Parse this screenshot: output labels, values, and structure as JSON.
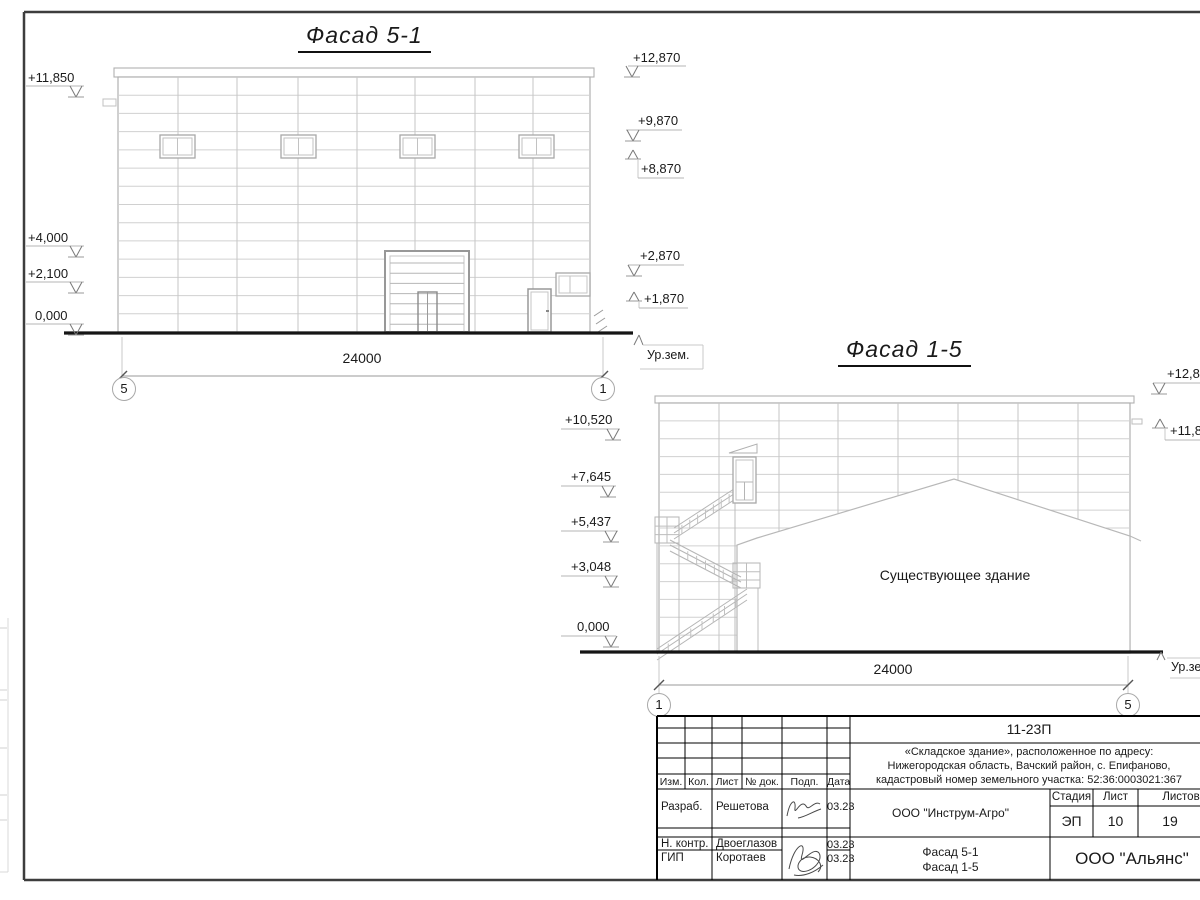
{
  "facade51": {
    "title": "Фасад 5-1",
    "marks_left": [
      "+11,850",
      "+4,000",
      "+2,100",
      "0,000"
    ],
    "marks_right": [
      "+12,870",
      "+9,870",
      "+8,870",
      "+2,870",
      "+1,870"
    ],
    "dim": "24000",
    "axis_left": "5",
    "axis_right": "1",
    "ground_label": "Ур.зем."
  },
  "facade15": {
    "title": "Фасад 1-5",
    "marks_left": [
      "+10,520",
      "+7,645",
      "+5,437",
      "+3,048",
      "0,000"
    ],
    "marks_right": [
      "+12,870",
      "+11,850"
    ],
    "dim": "24000",
    "axis_left": "1",
    "axis_right": "5",
    "ground_label": "Ур.зем",
    "existing_building_note": "Существующее здание"
  },
  "titleblock": {
    "code": "11-23П",
    "project_lines": [
      "«Складское здание», расположенное по адресу:",
      "Нижегородская область, Вачский район, с. Епифаново,",
      "кадастровый номер земельного участка: 52:36:0003021:367"
    ],
    "columns": [
      "Изм.",
      "Кол.",
      "Лист",
      "№ док.",
      "Подп.",
      "Дата"
    ],
    "rows": [
      {
        "role": "Разраб.",
        "name": "Решетова",
        "date": "03.23"
      },
      {
        "role": "Н. контр.",
        "name": "Двоеглазов",
        "date": "03.23"
      },
      {
        "role": "ГИП",
        "name": "Коротаев",
        "date": "03.23"
      }
    ],
    "organization": "ООО \"Инструм-Агро\"",
    "stage_label": "Стадия",
    "sheet_label": "Лист",
    "sheets_label": "Листов",
    "stage": "ЭП",
    "sheet": "10",
    "sheets": "19",
    "content_lines": [
      "Фасад 5-1",
      "Фасад 1-5"
    ],
    "company": "ООО \"Альянс\""
  }
}
